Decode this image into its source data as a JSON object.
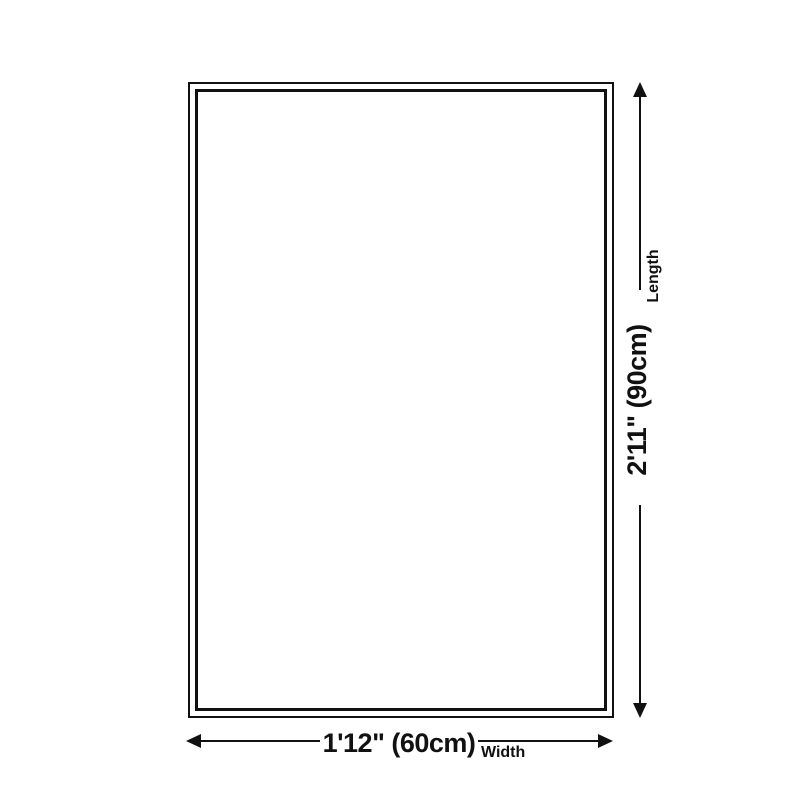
{
  "page": {
    "background_color": "#ffffff",
    "line_color": "#111111"
  },
  "diagram": {
    "shape": "rectangle-double-border",
    "length": {
      "value": "2'11\" (90cm)",
      "label": "Length"
    },
    "width": {
      "value": "1'12\" (60cm)",
      "label": "Width"
    }
  }
}
